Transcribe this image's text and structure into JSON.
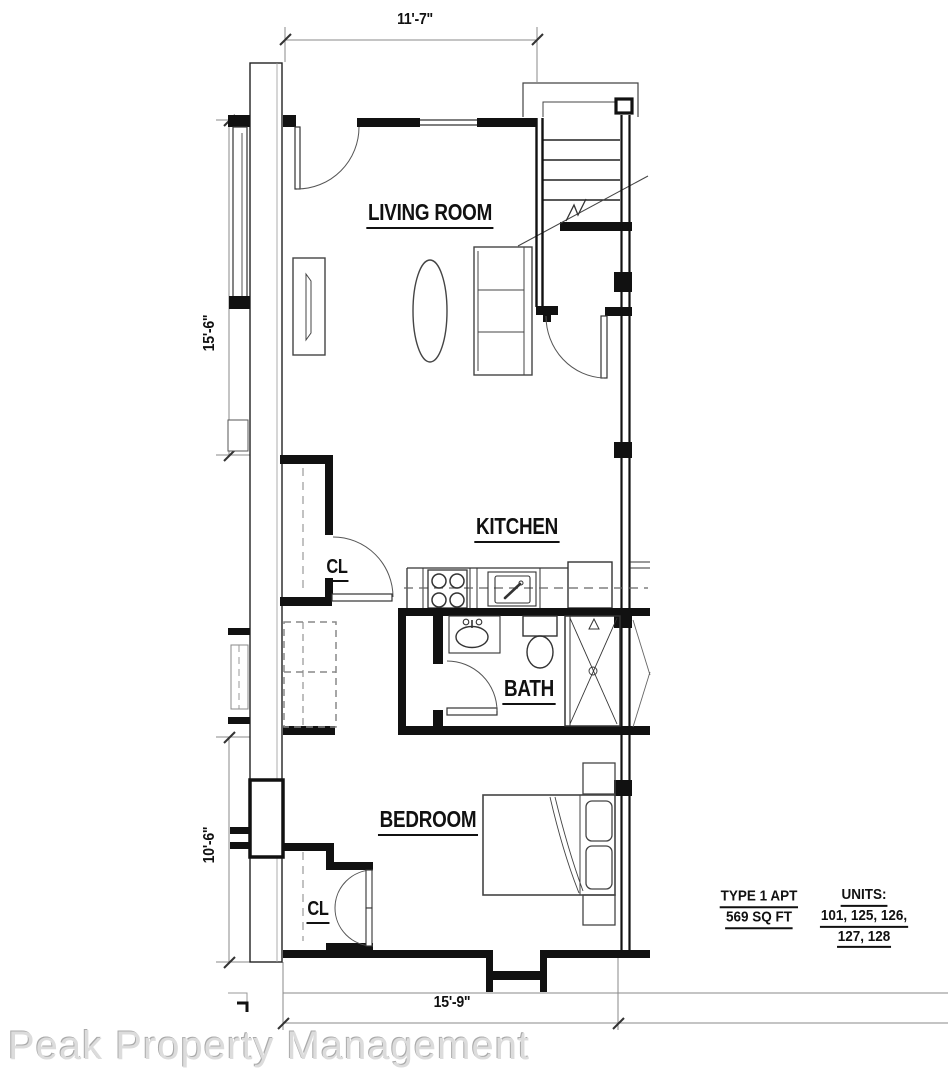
{
  "rooms": {
    "living_room": "LIVING ROOM",
    "kitchen": "KITCHEN",
    "bath": "BATH",
    "bedroom": "BEDROOM",
    "closet_upper": "CL",
    "closet_lower": "CL"
  },
  "dimensions": {
    "top": "11'-7\"",
    "left_upper": "15'-6\"",
    "left_lower": "10'-6\"",
    "bottom": "15'-9\""
  },
  "info": {
    "apt_type_line1": "TYPE 1 APT",
    "apt_type_line2": "569 SQ FT",
    "units_heading": "UNITS:",
    "units_line1": "101, 125, 126,",
    "units_line2": "127, 128"
  },
  "watermark": "Peak Property Management",
  "colors": {
    "wall": "#111111",
    "thin_line": "#2a2a2a",
    "dim_line": "#8a8a8a",
    "dashed_line": "#777777",
    "watermark_gray": "#dcdcdc"
  }
}
